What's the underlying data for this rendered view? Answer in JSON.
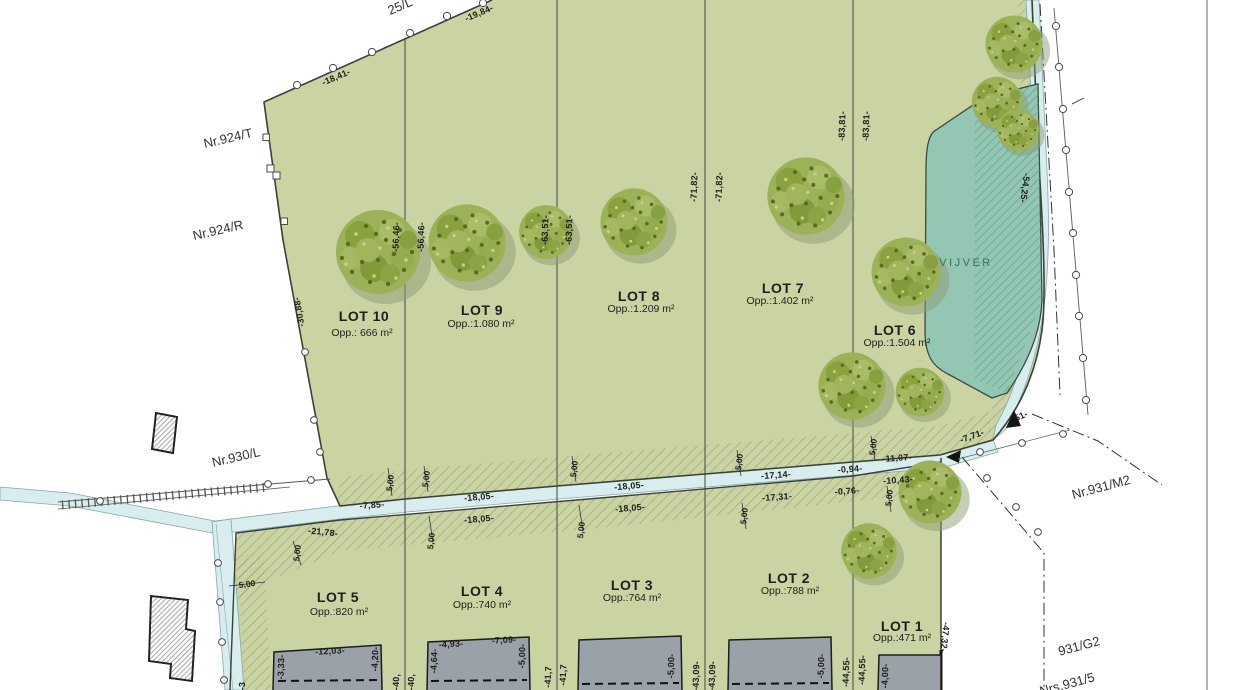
{
  "map": {
    "pond_label": "VIJVER",
    "tick": "5,00",
    "lots": [
      {
        "name": "LOT 10",
        "area": "Opp.: 666 m²"
      },
      {
        "name": "LOT 9",
        "area": "Opp.:1.080 m²"
      },
      {
        "name": "LOT 8",
        "area": "Opp.:1.209 m²"
      },
      {
        "name": "LOT 7",
        "area": "Opp.:1.402 m²"
      },
      {
        "name": "LOT 6",
        "area": "Opp.:1.504 m²"
      },
      {
        "name": "LOT 5",
        "area": "Opp.:820 m²"
      },
      {
        "name": "LOT 4",
        "area": "Opp.:740 m²"
      },
      {
        "name": "LOT 3",
        "area": "Opp.:764 m²"
      },
      {
        "name": "LOT 2",
        "area": "Opp.:788 m²"
      },
      {
        "name": "LOT 1",
        "area": "Opp.:471 m²"
      }
    ],
    "parcels": [
      {
        "t": "25/L"
      },
      {
        "t": "Nr.924/T"
      },
      {
        "t": "Nr.924/R"
      },
      {
        "t": "Nr.930/L"
      },
      {
        "t": "Nr.931/M2"
      },
      {
        "t": "931/G2"
      },
      {
        "t": "Nrs.931/5"
      }
    ],
    "dims": [
      {
        "t": "-18,41-"
      },
      {
        "t": "-19,84-"
      },
      {
        "t": "-30,88-"
      },
      {
        "t": "-56,46-"
      },
      {
        "t": "-56,46-"
      },
      {
        "t": "-63,51-"
      },
      {
        "t": "-63,51-"
      },
      {
        "t": "-71,82-"
      },
      {
        "t": "-71,82-"
      },
      {
        "t": "-83,81-"
      },
      {
        "t": "-83,81-"
      },
      {
        "t": "-54,25-"
      },
      {
        "t": "-7,85-"
      },
      {
        "t": "-18,05-"
      },
      {
        "t": "-18,05-"
      },
      {
        "t": "-18,05-"
      },
      {
        "t": "-18,05-"
      },
      {
        "t": "-17,14-"
      },
      {
        "t": "-17,31-"
      },
      {
        "t": "-0,94-"
      },
      {
        "t": "-0,76-"
      },
      {
        "t": "-11,07-"
      },
      {
        "t": "-10,43-"
      },
      {
        "t": "-7,71-"
      },
      {
        "t": "-21,78-"
      },
      {
        "t": "-47,32-"
      },
      {
        "t": "-44,55-"
      },
      {
        "t": "-44,55-"
      },
      {
        "t": "-43,09-"
      },
      {
        "t": "-43,09-"
      },
      {
        "t": "-41,7"
      },
      {
        "t": "-41,7"
      },
      {
        "t": "-40,"
      },
      {
        "t": "-40,"
      },
      {
        "t": "-12,03-"
      },
      {
        "t": "-3,33-"
      },
      {
        "t": "-4,20-"
      },
      {
        "t": "-4,93-"
      },
      {
        "t": "-7,09-"
      },
      {
        "t": "-4,64-"
      },
      {
        "t": "-5,00-"
      },
      {
        "t": "-5,00-"
      },
      {
        "t": "-5,00-"
      },
      {
        "t": "-4,00-"
      },
      {
        "t": "51-"
      },
      {
        "t": "-3"
      }
    ],
    "colors": {
      "parcel_green": "#cad4a3",
      "pond_teal": "#93c7b4",
      "ditch_blue": "#d8edee",
      "building_gray": "#9aa1a9",
      "tree_green": "#9cb258"
    }
  }
}
